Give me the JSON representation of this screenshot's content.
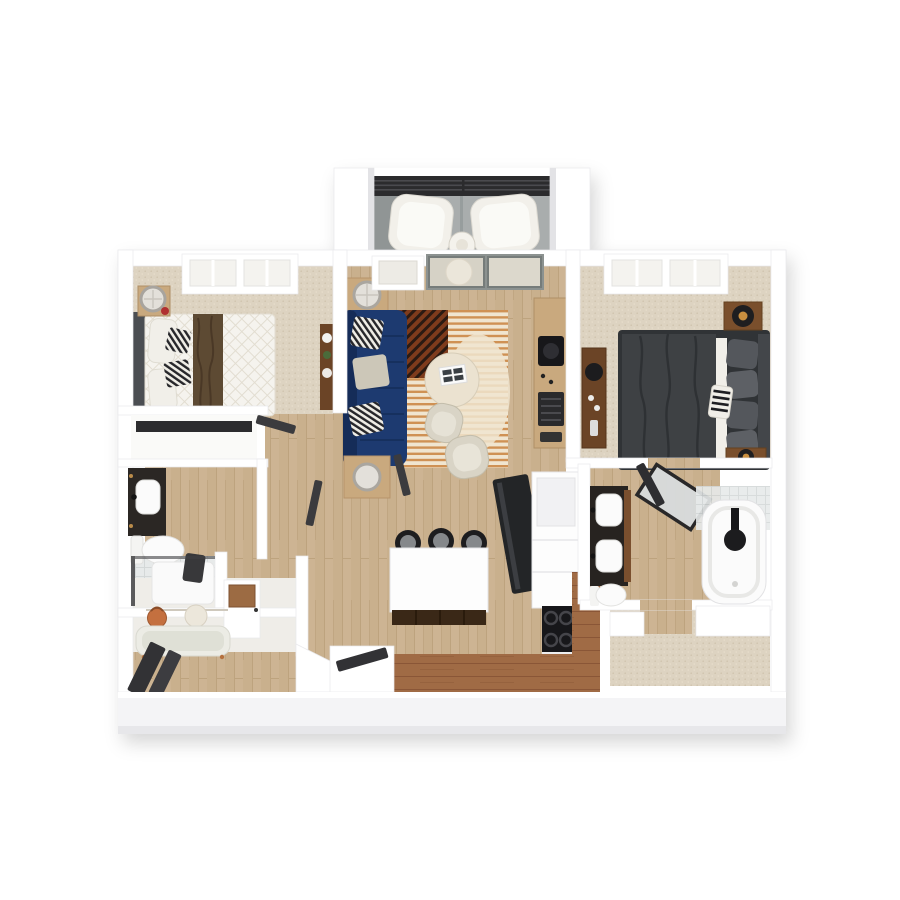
{
  "image": {
    "kind": "3d-floorplan-render",
    "description": "Top-down 3D rendering of a two-bedroom, two-bathroom apartment floor plan with a balcony at top center",
    "background": "#ffffff"
  },
  "palette": {
    "bg": "#ffffff",
    "wall": "#ffffff",
    "wall-edge": "#e9e9ec",
    "wall-shade": "#e3e3e6",
    "fascia": "#f4f4f6",
    "fascia-deep": "#e7e7ea",
    "wood": "#cdb493",
    "wood-line": "#bda37e",
    "carpet": "#ddd3c1",
    "carpet-dot": "#cfc3ad",
    "carpet-dot2": "#e8dfcd",
    "concrete": "#a9adad",
    "concrete-dark": "#909595",
    "railing": "#2b2b2d",
    "rail-slat": "#4a4a4e",
    "sofa-navy": "#1d3a70",
    "sofa-navy-dark": "#152c58",
    "rug-cream": "#f0e5d0",
    "rug-orange": "#cf9154",
    "rug-rust": "#7e3b1c",
    "rug-rust-stripe": "#2b1a12",
    "quilt-white": "#f5f3ee",
    "quilt-line": "#e2ddd1",
    "throw-brown": "#5d4a33",
    "throw-brown-dark": "#4a3826",
    "bed-dark": "#3e4144",
    "bed-frame": "#303336",
    "pillow-gray": "#54575c",
    "linen-white": "#f1efe9",
    "wood-mid": "#6b4426",
    "wood-light": "#c9a97e",
    "counter-wood": "#a06b45",
    "counter-wood-line": "#8a5637",
    "appliance-black": "#17171a",
    "burner-gray": "#45454a",
    "stool-ring": "#1d1d1f",
    "stool-seat": "#85888b",
    "island-white": "#fdfdfd",
    "island-base": "#3a2817",
    "fixture-white": "#fbfbfb",
    "fixture-edge": "#e2e2e4",
    "tile": "#e7eaea",
    "tile-line": "#d2d7d7",
    "glass": "#d6d2c6",
    "glass-frame": "#8c9290",
    "door-dark": "#323235",
    "bench-sage": "#dfe0d6",
    "bag-orange": "#c4703f",
    "hat-cream": "#ece7db",
    "lamp-shade": "#e3e0da",
    "lamp-ring": "#a8a49e",
    "lamp-black": "#1e1e20",
    "lamp-amber": "#c98f3f",
    "flower-red": "#b03030",
    "plant-green": "#4a6b3a",
    "chair-cream": "#d9d4c6",
    "chair-cream-edge": "#c3bdab",
    "table-cream": "#ebe2d0",
    "book-white": "#fafafa",
    "book-ink": "#3a3f44"
  },
  "scene": {
    "rooms": [
      {
        "id": "balcony",
        "furniture": [
          "lounge-chair",
          "lounge-chair",
          "round-side-table",
          "metal-railing"
        ]
      },
      {
        "id": "living-room",
        "furniture": [
          "navy-sofa",
          "striped-rug",
          "round-coffee-table",
          "accent-chair",
          "accent-chair",
          "side-table-lamp",
          "side-table-lamp",
          "media-console"
        ]
      },
      {
        "id": "bedroom-left",
        "furniture": [
          "queen-bed-white",
          "nightstand-lamp",
          "dresser",
          "reach-in-closet",
          "window"
        ]
      },
      {
        "id": "bedroom-right",
        "furniture": [
          "queen-bed-charcoal",
          "nightstand-lamp",
          "nightstand-lamp",
          "dresser",
          "window"
        ]
      },
      {
        "id": "kitchen",
        "furniture": [
          "island-with-stools",
          "range-stove",
          "refrigerator",
          "l-shaped-counter",
          "white-cabinets"
        ]
      },
      {
        "id": "bathroom-left",
        "furniture": [
          "vanity-sink",
          "toilet",
          "glass-shower"
        ]
      },
      {
        "id": "bathroom-right",
        "furniture": [
          "double-vanity",
          "bathtub",
          "toilet",
          "mirror-door"
        ]
      },
      {
        "id": "entry-mudroom",
        "furniture": [
          "bench",
          "wall-hooks",
          "storage-cabinet",
          "entry-door"
        ]
      },
      {
        "id": "walk-in-closet",
        "furniture": [
          "shelving"
        ]
      }
    ]
  }
}
